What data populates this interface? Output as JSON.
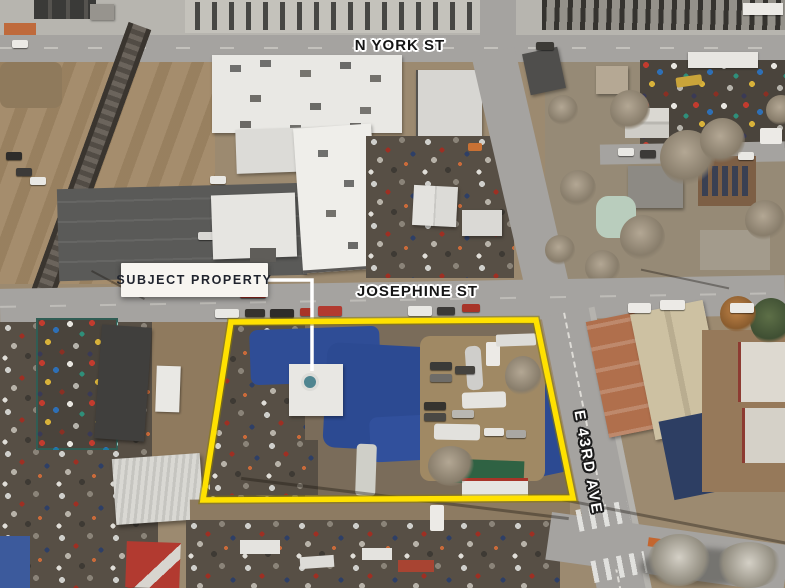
{
  "labels": {
    "n_york": "N YORK ST",
    "josephine": "JOSEPHINE ST",
    "e_43rd": "E 43RD AVE",
    "callout": "SUBJECT PROPERTY"
  },
  "colors": {
    "property_outline": "#FFE100",
    "property_outline_edge": "#8A7A00",
    "callout_background": "#F7F5F0",
    "callout_text": "#20242E",
    "street_label_dark": "#151515",
    "street_label_light": "#FFFFFF",
    "leader_line": "#FFFFFF"
  }
}
